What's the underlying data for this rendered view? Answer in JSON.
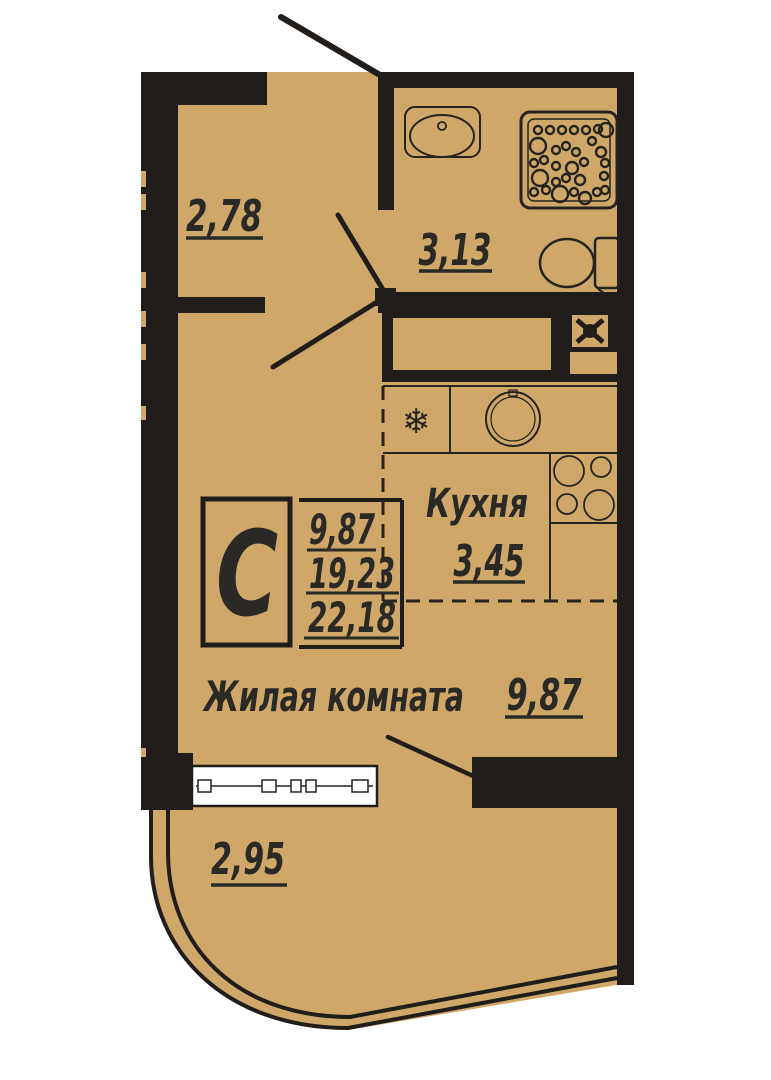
{
  "plan": {
    "type_letter": "С",
    "stats": {
      "living_area": "9,87",
      "area_without_balcony": "19,23",
      "total_area": "22,18"
    },
    "rooms": {
      "hallway": {
        "area": "2,78"
      },
      "bathroom": {
        "area": "3,13"
      },
      "kitchen": {
        "label": "Кухня",
        "area": "3,45"
      },
      "living_room": {
        "label": "Жилая комната",
        "area": "9,87"
      },
      "balcony": {
        "area": "2,95"
      }
    },
    "icons": {
      "fridge_icon": "❄"
    }
  },
  "colors": {
    "floor": "#CFA869",
    "wall": "#201D1A",
    "line": "#26231F",
    "text": "#2B2926",
    "background": "#FFFFFF"
  }
}
